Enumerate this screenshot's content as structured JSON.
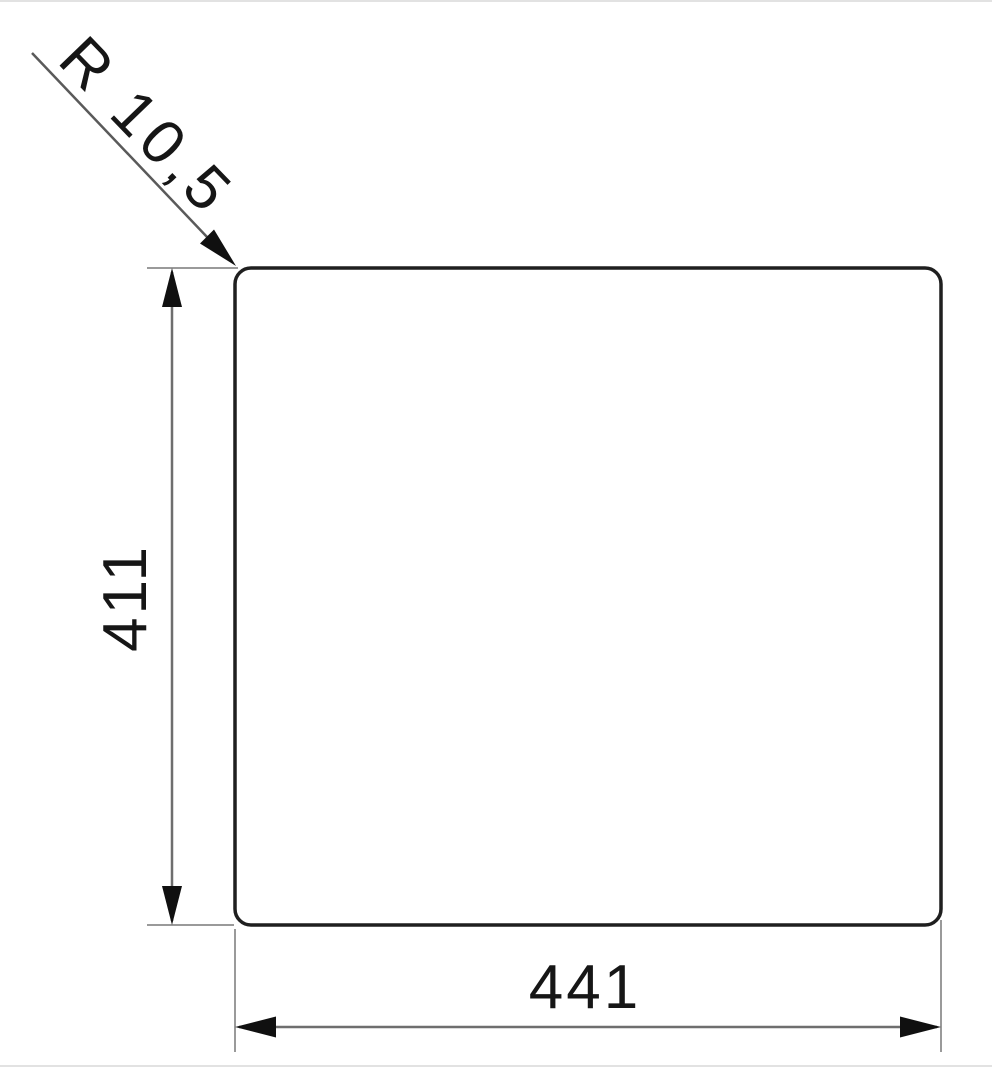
{
  "drawing": {
    "title": "cutout-dimension-drawing",
    "radius_label": "R 10,5",
    "height_label": "411",
    "width_label": "441"
  },
  "colors": {
    "outline": "#1f1f1f",
    "dimension_line": "#6e6e6e",
    "extension_line": "#9a9a9a",
    "leader_line": "#5a5a5a",
    "arrow": "#101010",
    "text": "#161616",
    "background": "#ffffff"
  }
}
